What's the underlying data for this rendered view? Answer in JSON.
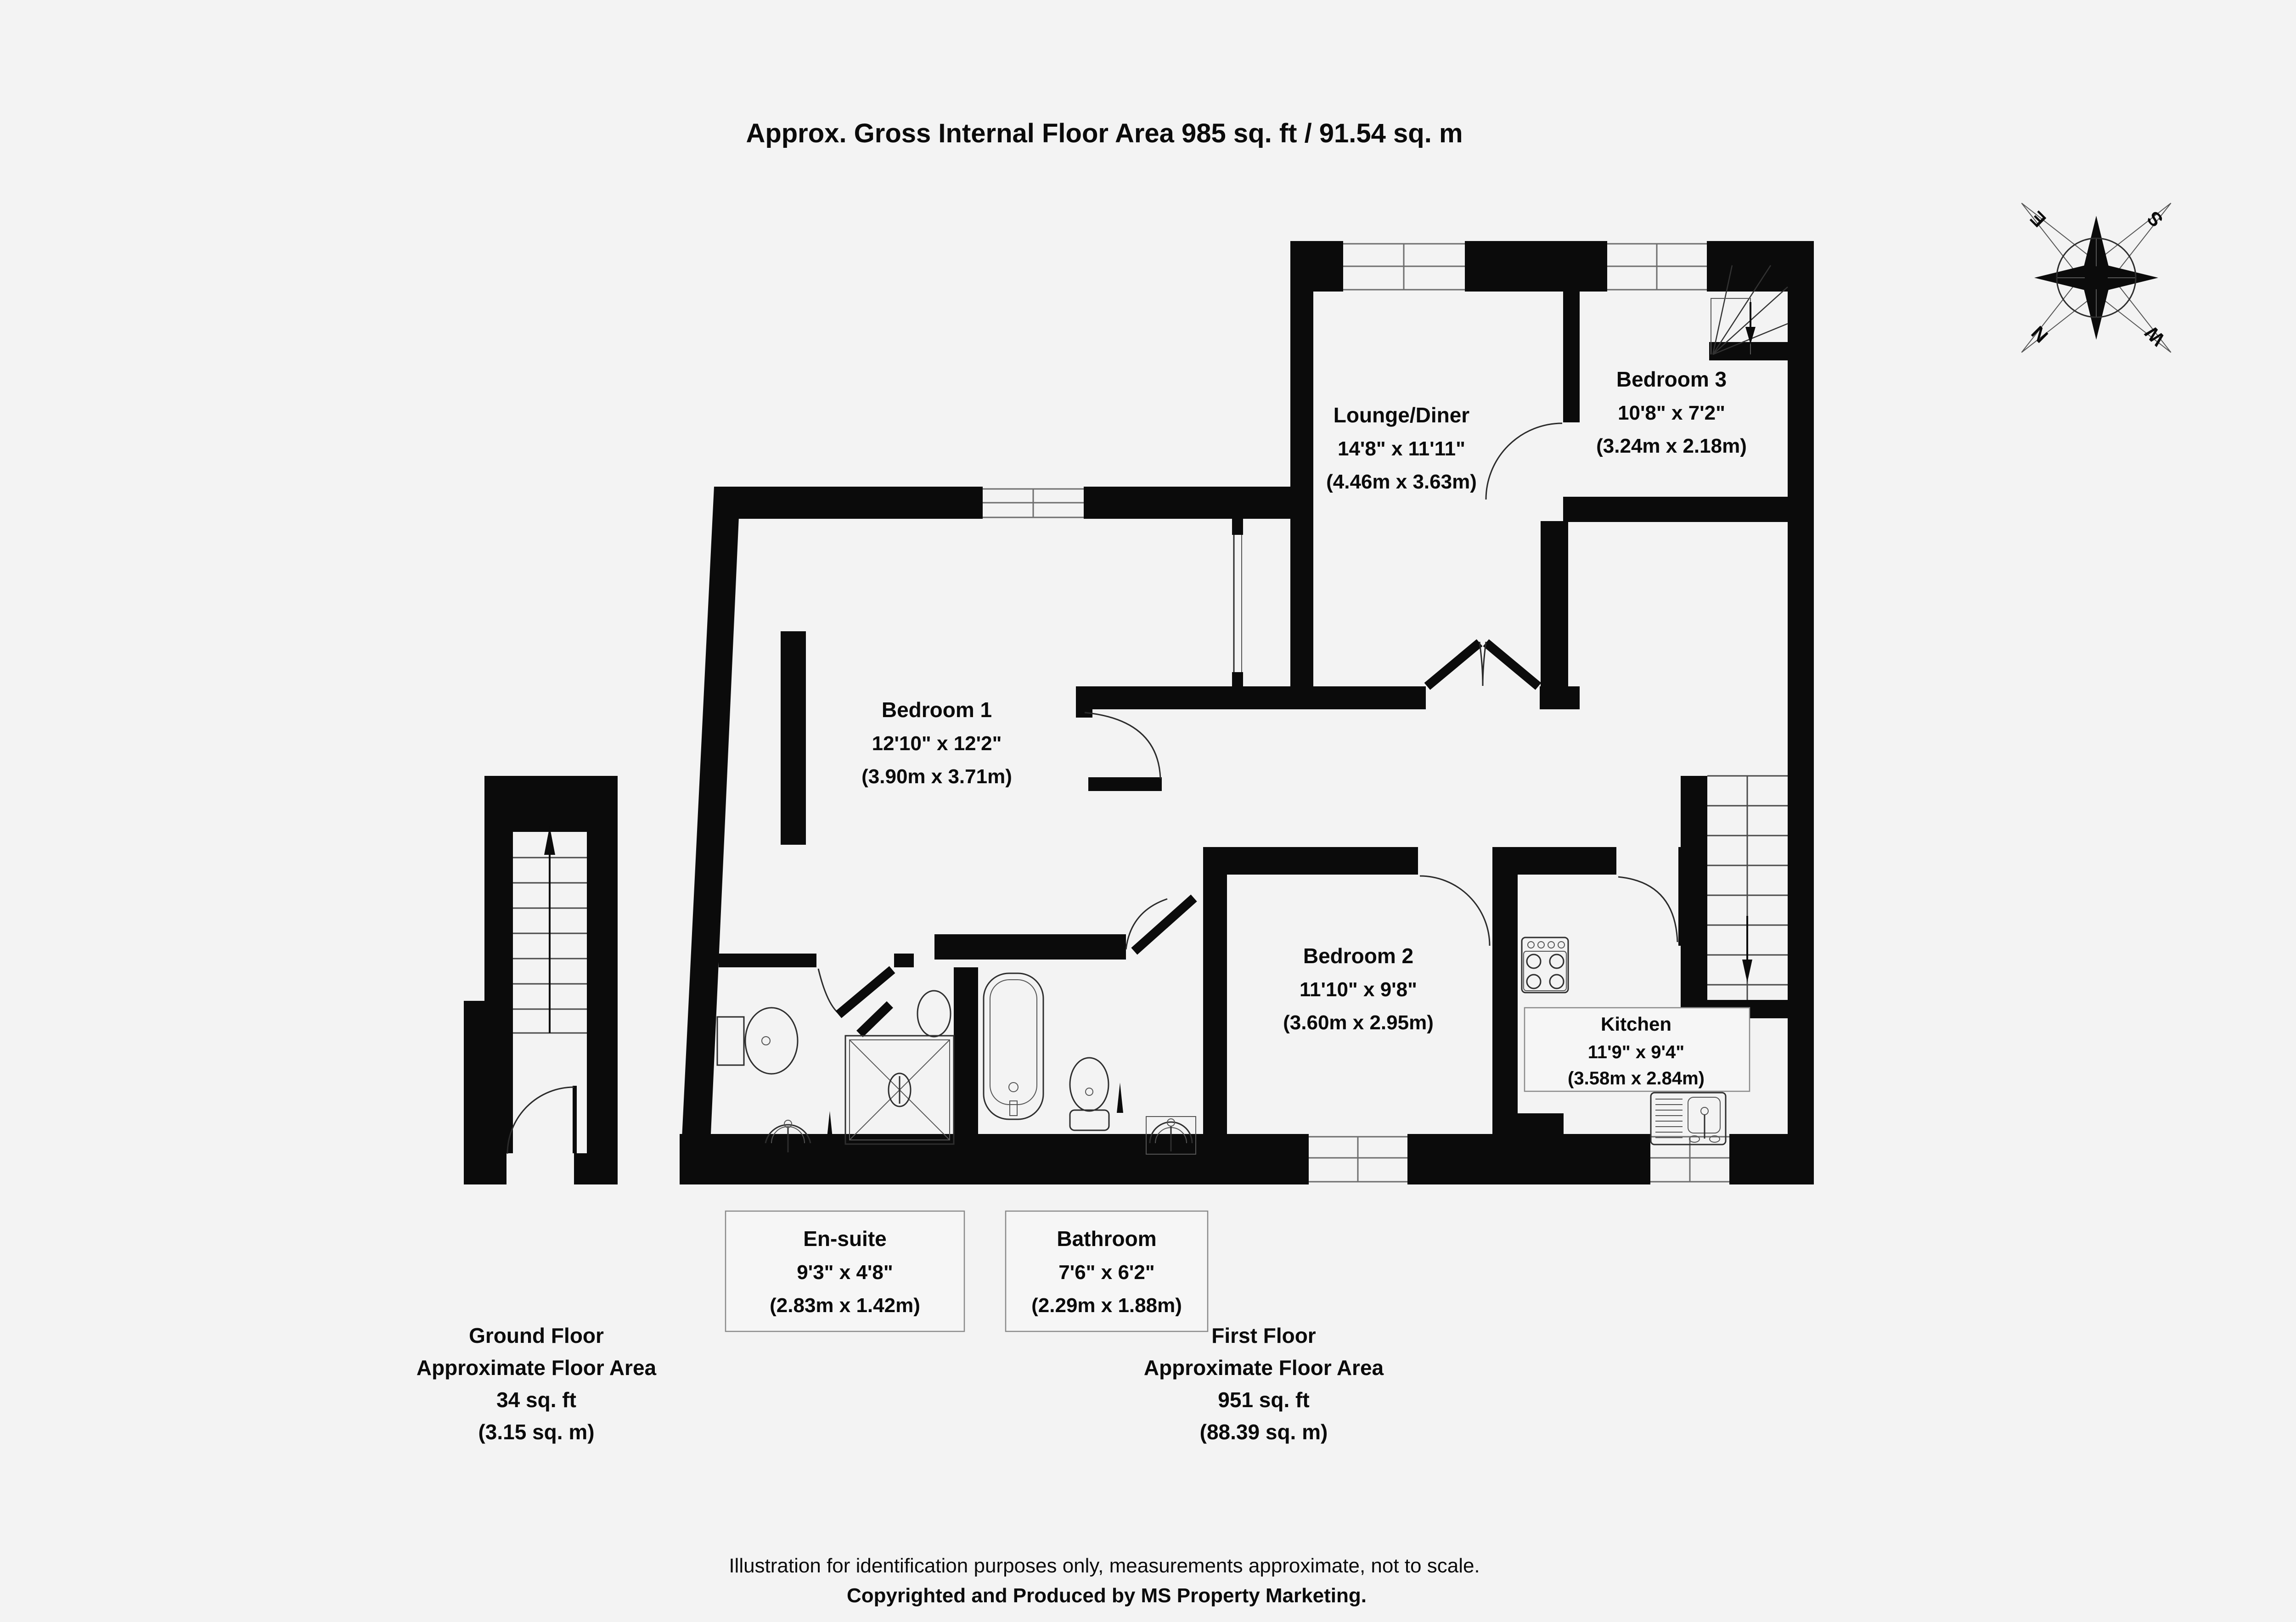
{
  "title": "Approx. Gross Internal Floor Area 985 sq. ft / 91.54 sq. m",
  "compass": {
    "n": "N",
    "e": "E",
    "s": "S",
    "w": "W"
  },
  "rooms": {
    "lounge": {
      "name": "Lounge/Diner",
      "imperial": "14'8\" x 11'11\"",
      "metric": "(4.46m x 3.63m)"
    },
    "bedroom3": {
      "name": "Bedroom 3",
      "imperial": "10'8\" x 7'2\"",
      "metric": "(3.24m x 2.18m)"
    },
    "bedroom1": {
      "name": "Bedroom 1",
      "imperial": "12'10\" x 12'2\"",
      "metric": "(3.90m x 3.71m)"
    },
    "bedroom2": {
      "name": "Bedroom 2",
      "imperial": "11'10\" x 9'8\"",
      "metric": "(3.60m x 2.95m)"
    },
    "kitchen": {
      "name": "Kitchen",
      "imperial": "11'9\" x 9'4\"",
      "metric": "(3.58m x 2.84m)"
    },
    "ensuite": {
      "name": "En-suite",
      "imperial": "9'3\" x 4'8\"",
      "metric": "(2.83m x 1.42m)"
    },
    "bathroom": {
      "name": "Bathroom",
      "imperial": "7'6\" x 6'2\"",
      "metric": "(2.29m x 1.88m)"
    }
  },
  "floors": {
    "ground": {
      "name": "Ground Floor",
      "area_label": "Approximate Floor Area",
      "sqft": "34 sq. ft",
      "sqm": "(3.15 sq. m)"
    },
    "first": {
      "name": "First Floor",
      "area_label": "Approximate Floor Area",
      "sqft": "951 sq. ft",
      "sqm": "(88.39 sq. m)"
    }
  },
  "footer": {
    "line1": "Illustration for identification purposes only, measurements approximate, not to scale.",
    "line2": "Copyrighted  and Produced by MS Property Marketing."
  }
}
